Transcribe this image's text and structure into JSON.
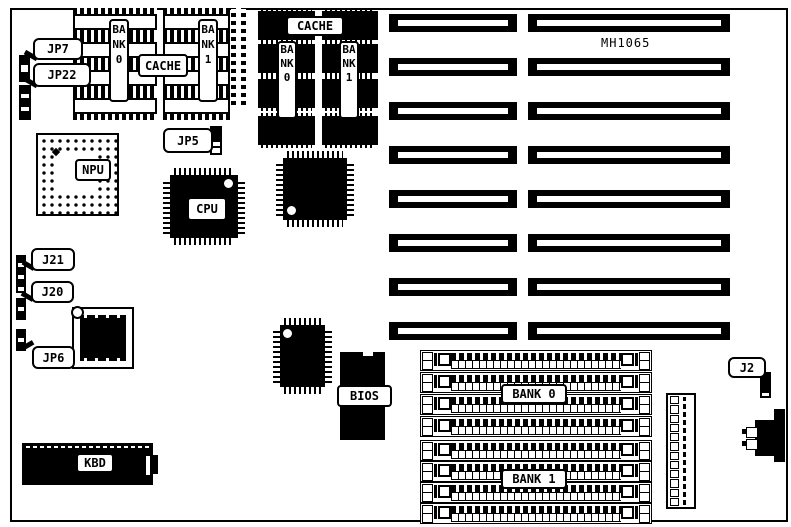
{
  "colors": {
    "ink": "#000000",
    "paper": "#ffffff"
  },
  "board": {
    "model": "MH1065"
  },
  "callouts": {
    "jp7": "JP7",
    "jp22": "JP22",
    "jp5": "JP5",
    "j21": "J21",
    "j20": "J20",
    "jp6": "JP6",
    "j2": "J2"
  },
  "chips": {
    "npu": "NPU",
    "cpu": "CPU",
    "bios": "BIOS",
    "kbd": "KBD"
  },
  "cache_sram": {
    "label": "CACHE",
    "bank0": "BANK0",
    "bank1": "BANK1"
  },
  "cache_dip": {
    "label": "CACHE",
    "bank0": "BANK0",
    "bank1": "BANK1"
  },
  "memory": {
    "bank0": "BANK 0",
    "bank1": "BANK 1"
  }
}
